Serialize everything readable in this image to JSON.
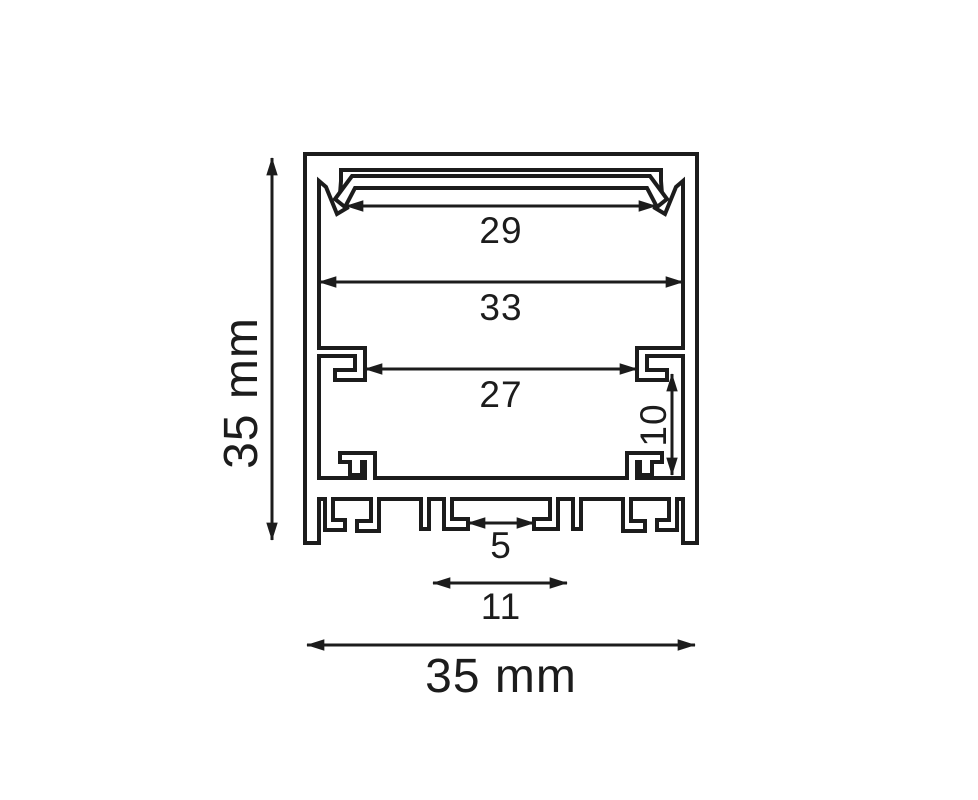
{
  "drawing": {
    "description": "aluminium-led-profile-cross-section",
    "unit": "mm",
    "line_color": "#1c1c1c",
    "background_color": "#ffffff",
    "labels": {
      "overall_height": "35 mm",
      "overall_width": "35 mm",
      "diffuser_opening_width": "29",
      "inner_cavity_width": "33",
      "hook_span_width": "27",
      "side_channel_height": "10",
      "base_slot_gap": "5",
      "base_channel_width": "11"
    }
  }
}
